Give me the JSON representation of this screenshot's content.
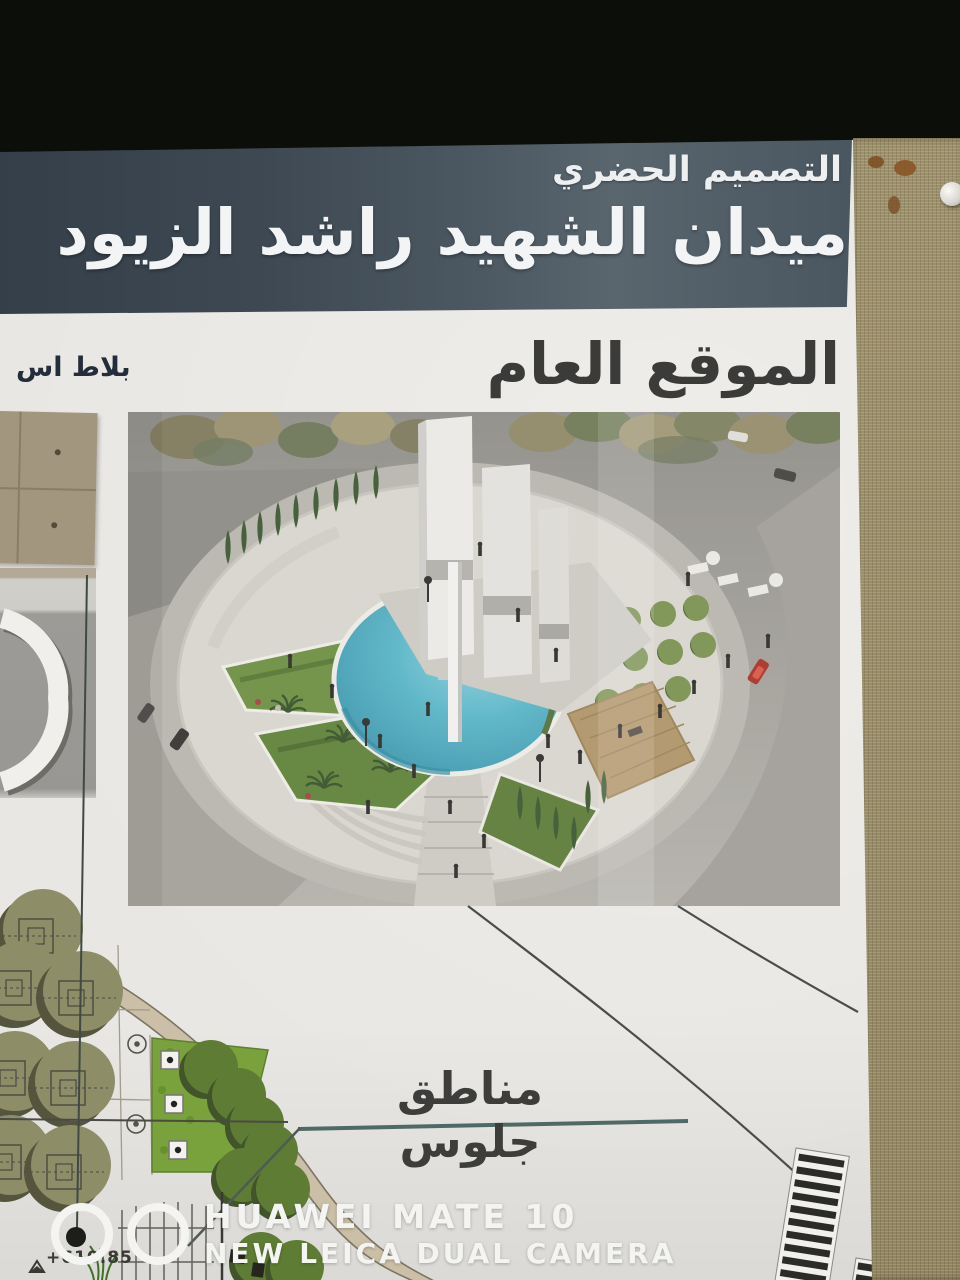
{
  "poster": {
    "header": {
      "subtitle": "التصميم الحضري",
      "title": "ميدان الشهيد راشد الزيود"
    },
    "section_title": "الموقع العام",
    "material_label_partial": "بلاط اس",
    "seating_area_label": "مناطق جلوس",
    "spot_elevation": "+610.85"
  },
  "watermark": {
    "line1": "HUAWEI MATE 10",
    "line2": "NEW LEICA DUAL CAMERA"
  },
  "colors": {
    "black_band": "#0c0e09",
    "header_band": "#4b5761",
    "header_text": "#f2f4f5",
    "poster_paper": "#eeece8",
    "title_text": "#3b3b3a",
    "pool_water": "#58b4c6",
    "landscape_green": "#6d8f42",
    "fabric_board": "#a1946d",
    "watermark_text": "#f4f4f2"
  }
}
